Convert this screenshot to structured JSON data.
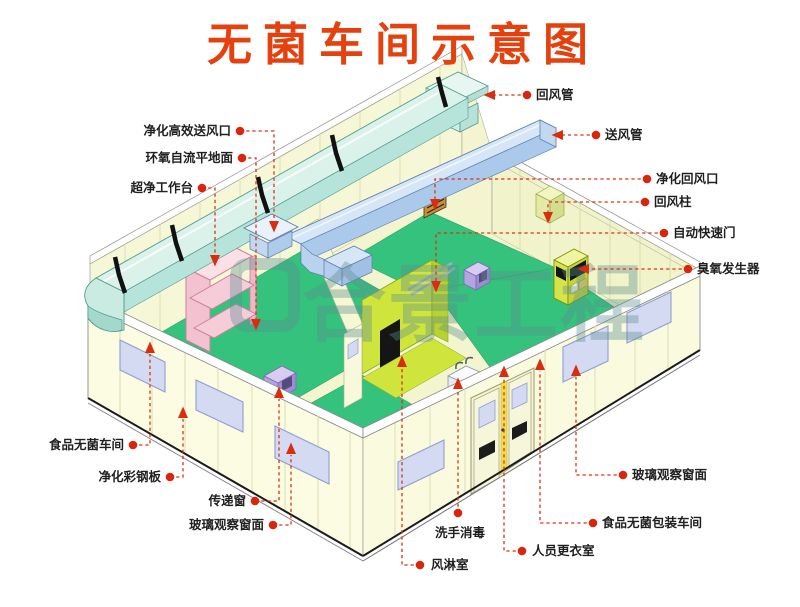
{
  "title": {
    "text": "无菌车间示意图",
    "color": "#e5410e"
  },
  "watermark": {
    "text": "合景工程"
  },
  "labels": [
    {
      "text": "净化高效送风口"
    },
    {
      "text": "环氧自流平地面"
    },
    {
      "text": "超净工作台"
    },
    {
      "text": "食品无菌车间"
    },
    {
      "text": "净化彩钢板"
    },
    {
      "text": "传递窗"
    },
    {
      "text": "玻璃观察窗面"
    },
    {
      "text": "洗手消毒"
    },
    {
      "text": "风淋室"
    },
    {
      "text": "人员更衣室"
    },
    {
      "text": "回风管"
    },
    {
      "text": "送风管"
    },
    {
      "text": "净化回风口"
    },
    {
      "text": "回风柱"
    },
    {
      "text": "自动快速门"
    },
    {
      "text": "臭氧发生器"
    },
    {
      "text": "玻璃观察窗面"
    },
    {
      "text": "食品无菌包装车间"
    }
  ],
  "colors": {
    "title_red": "#e5410e",
    "leader_red": "#da330f",
    "wall_cream": "#f8f9dd",
    "floor_green": "#34c27c",
    "floor_chartreuse": "#cfe53c",
    "return_duct_cyan": "#daf2ea",
    "supply_duct_blue": "#d6e6f7",
    "window_blue": "#d5daf3",
    "workbench_pink": "#f8d4de",
    "watermark_teal": "#5d8e92"
  }
}
